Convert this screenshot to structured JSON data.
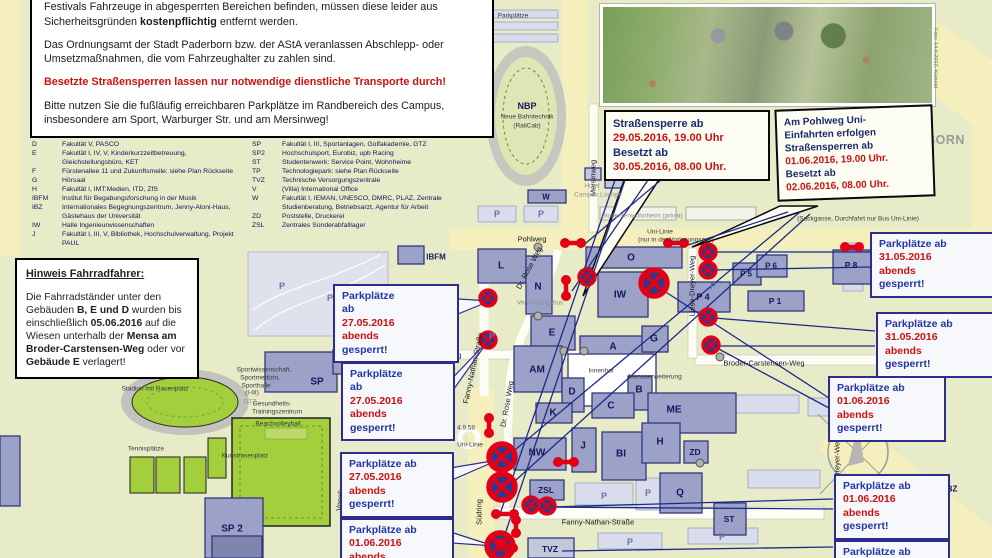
{
  "colors": {
    "accent_red": "#cc1111",
    "navy": "#2b2e8f",
    "sign_red": "#e30016",
    "sign_blue": "#2b3990",
    "map_green": "#e7ebc8",
    "street_yellow": "#f5efbe",
    "field_green": "#a3cf3c",
    "building": "#9ba1c7"
  },
  "info_box": {
    "p1": [
      {
        "t": "Verbotszeichen abgesperrt. Sollten sich während des Festivalaufbaues oder während des Festivals Fahrzeuge in abgesperrten Bereichen befinden, müssen diese leider aus Sicherheitsgründen "
      },
      {
        "t": "kostenpflichtig",
        "b": 1
      },
      {
        "t": " entfernt werden."
      }
    ],
    "p2": "Das Ordnungsamt der Stadt Paderborn bzw. der AStA veranlassen Abschlepp- oder Umsetzmaßnahmen, die vom Fahrzeughalter zu zahlen sind.",
    "p3": "Besetzte Straßensperren lassen nur notwendige dienstliche Transporte durch!",
    "p4": "Bitte nutzen Sie die fußläufig erreichbaren Parkplätze im Randbereich des Campus, insbesondere am Sport, Warburger Str. und am Mersinweg!"
  },
  "legend": {
    "col1": [
      {
        "code": "D",
        "text": "Fakultät V, PASCO"
      },
      {
        "code": "E",
        "text": "Fakultät I, IV, V, Kinderkurzzeitbetreuung, Gleichstellungsbüro, KET"
      },
      {
        "code": "F",
        "text": "Fürstenallee 11 und Zukunftsmeile: siehe Plan Rückseite"
      },
      {
        "code": "G",
        "text": "Hörsaal"
      },
      {
        "code": "H",
        "text": "Fakultät I, IMT:Medien, ITD, ZfS"
      },
      {
        "code": "IBFM",
        "text": "Institut für Begabungsforschung in der Musik"
      },
      {
        "code": "IBZ",
        "text": "Internationales Begegnungszentrum, Jenny-Aloni-Haus, Gästehaus der Universität"
      },
      {
        "code": "IW",
        "text": "Halle Ingenieurwissenschaften"
      },
      {
        "code": "J",
        "text": "Fakultät I, III, V, Bibliothek, Hochschulverwaltung, Projekt PAUL"
      }
    ],
    "col2": [
      {
        "code": "SP",
        "text": "Fakultät I, III, Sportanlagen, Golfakademie, GTZ"
      },
      {
        "code": "SP2",
        "text": "Hochschulsport, Eurobiz, upb Racing"
      },
      {
        "code": "ST",
        "text": "Studentenwerk: Service Point, Wohnheime"
      },
      {
        "code": "TP",
        "text": "Technologiepark: siehe Plan Rückseite"
      },
      {
        "code": "TVZ",
        "text": "Technische Versorgungszentrale"
      },
      {
        "code": "V",
        "text": "(Villa) International Office"
      },
      {
        "code": "W",
        "text": "Fakultät I, IEMAN, UNESCO, DMRC, PLAZ, Zentrale Studienberatung, Betriebsarzt, Agentur für Arbeit"
      },
      {
        "code": "ZD",
        "text": "Poststelle, Druckerei"
      },
      {
        "code": "ZSL",
        "text": "Zentrales Sonderabfalllager"
      }
    ]
  },
  "bike_note": {
    "title": "Hinweis Fahrradfahrer:",
    "body": [
      {
        "t": "Die Fahrradständer unter den Gebäuden "
      },
      {
        "t": "B, E und D",
        "b": 1
      },
      {
        "t": " wurden bis einschließlich "
      },
      {
        "t": "05.06.2016",
        "b": 1
      },
      {
        "t": " auf die Wiesen unterhalb der "
      },
      {
        "t": "Mensa am Broder-Carstensen-Weg",
        "b": 1
      },
      {
        "t": " oder vor "
      },
      {
        "t": "Gebäude E",
        "b": 1
      },
      {
        "t": " verlagert!"
      }
    ]
  },
  "roadblock_boxes": [
    {
      "x": 604,
      "y": 110,
      "w": 148,
      "fs": 11,
      "lines": [
        {
          "t": "Straßensperre  ab",
          "c": "t"
        },
        {
          "t": "29.05.2016, 19.00 Uhr",
          "c": "d"
        },
        {
          "t": "Besetzt ab",
          "c": "t"
        },
        {
          "t": "30.05.2016, 08.00 Uhr.",
          "c": "d"
        }
      ]
    },
    {
      "x": 776,
      "y": 107,
      "w": 140,
      "fs": 10,
      "rot": -2,
      "lines": [
        {
          "t": "Am Pohlweg Uni-",
          "c": "t"
        },
        {
          "t": "Einfahrten erfolgen",
          "c": "t"
        },
        {
          "t": "Straßensperren  ab",
          "c": "t"
        },
        {
          "t": "01.06.2016, 19.00 Uhr.",
          "c": "d"
        },
        {
          "t": "Besetzt ab",
          "c": "t"
        },
        {
          "t": "02.06.2016, 08.00 Uhr.",
          "c": "d"
        }
      ]
    }
  ],
  "parking_boxes": [
    {
      "x": 333,
      "y": 284,
      "w": 108,
      "lines": [
        {
          "t": "Parkplätze",
          "c": "t"
        },
        {
          "t": "ab",
          "c": "t"
        },
        {
          "t": "27.05.2016",
          "c": "d"
        },
        {
          "t": "abends",
          "c": "d"
        },
        {
          "t": "gesperrt!",
          "c": "t"
        }
      ]
    },
    {
      "x": 341,
      "y": 362,
      "w": 96,
      "lines": [
        {
          "t": "Parkplätze",
          "c": "t"
        },
        {
          "t": "ab",
          "c": "t"
        },
        {
          "t": "27.05.2016",
          "c": "d"
        },
        {
          "t": "abends",
          "c": "d"
        },
        {
          "t": "gesperrt!",
          "c": "t"
        }
      ]
    },
    {
      "x": 340,
      "y": 452,
      "w": 96,
      "lines": [
        {
          "t": "Parkplätze ab",
          "c": "t"
        },
        {
          "t": "27.05.2016",
          "c": "d"
        },
        {
          "t": "abends",
          "c": "d"
        },
        {
          "t": "gesperrt!",
          "c": "t"
        }
      ]
    },
    {
      "x": 340,
      "y": 518,
      "w": 96,
      "lines": [
        {
          "t": "Parkplätze ab",
          "c": "t"
        },
        {
          "t": "01.06.2016",
          "c": "d"
        },
        {
          "t": "abends",
          "c": "d"
        }
      ]
    },
    {
      "x": 870,
      "y": 232,
      "w": 106,
      "lines": [
        {
          "t": "Parkplätze ab",
          "c": "t"
        },
        {
          "t": "31.05.2016",
          "c": "d"
        },
        {
          "t": "abends",
          "c": "d"
        },
        {
          "t": "gesperrt!",
          "c": "t"
        }
      ]
    },
    {
      "x": 876,
      "y": 312,
      "w": 100,
      "lines": [
        {
          "t": "Parkplätze ab",
          "c": "t"
        },
        {
          "t": "31.05.2016",
          "c": "d"
        },
        {
          "t": "abends",
          "c": "d"
        },
        {
          "t": "gesperrt!",
          "c": "t"
        }
      ]
    },
    {
      "x": 828,
      "y": 376,
      "w": 100,
      "lines": [
        {
          "t": "Parkplätze ab",
          "c": "t"
        },
        {
          "t": "01.06.2016",
          "c": "d"
        },
        {
          "t": "abends",
          "c": "d"
        },
        {
          "t": "gesperrt!",
          "c": "t"
        }
      ]
    },
    {
      "x": 834,
      "y": 474,
      "w": 98,
      "lines": [
        {
          "t": "Parkplätze ab",
          "c": "t"
        },
        {
          "t": "01.06.2016",
          "c": "d"
        },
        {
          "t": "abends",
          "c": "d"
        },
        {
          "t": "gesperrt!",
          "c": "t"
        }
      ]
    },
    {
      "x": 834,
      "y": 540,
      "w": 98,
      "lines": [
        {
          "t": "Parkplätze ab",
          "c": "t"
        },
        {
          "t": "31.05.2016",
          "c": "d"
        }
      ]
    }
  ],
  "logo": {
    "line1": "UNIVERSITÄT PADERBORN",
    "line2": "Die Universität der Informationsgesellschaft"
  },
  "photo": {
    "caption": "Foto: 14.6.2013, Kiebold"
  },
  "compass": {
    "label": "N"
  },
  "map": {
    "labels": [
      {
        "t": "Pohlweg",
        "x": 532,
        "y": 239,
        "cls": "street"
      },
      {
        "t": "Südring",
        "x": 470,
        "y": 88,
        "cls": "street",
        "r": -90
      },
      {
        "t": "Südring",
        "x": 479,
        "y": 512,
        "cls": "street",
        "r": -90
      },
      {
        "t": "Mersinweg",
        "x": 593,
        "y": 178,
        "cls": "street",
        "r": -90
      },
      {
        "t": "Harsewinkelweg",
        "x": 434,
        "y": 355,
        "cls": "street"
      },
      {
        "t": "Dr. Rose Weg",
        "x": 529,
        "y": 268,
        "cls": "street",
        "r": -62
      },
      {
        "t": "Dr. Rose Weg",
        "x": 507,
        "y": 404,
        "cls": "street",
        "r": -80
      },
      {
        "t": "Fanny-Nathan-Straße",
        "x": 473,
        "y": 368,
        "cls": "street",
        "r": -78
      },
      {
        "t": "Fanny-Nathan-Straße",
        "x": 598,
        "y": 522,
        "cls": "street"
      },
      {
        "t": "Liese-Dreyer-Weg",
        "x": 692,
        "y": 286,
        "cls": "street",
        "r": -90
      },
      {
        "t": "Liese-Dreyer-Weg",
        "x": 837,
        "y": 468,
        "cls": "street",
        "r": -90
      },
      {
        "t": "Broder-Carstensen-Weg",
        "x": 764,
        "y": 363,
        "cls": "street"
      },
      {
        "t": "Vogeliusweg",
        "x": 341,
        "y": 490,
        "cls": "street",
        "r": -83
      },
      {
        "t": "Uni-Linie",
        "x": 470,
        "y": 445,
        "cls": "sk"
      },
      {
        "t": "4.9.58",
        "x": 466,
        "y": 428,
        "cls": "sk"
      },
      {
        "t": "Uni-Linie",
        "x": 660,
        "y": 232,
        "cls": "sk"
      },
      {
        "t": "(nur in der Vorlesungszeit)",
        "x": 676,
        "y": 240,
        "cls": "sk"
      },
      {
        "t": "(Sackgasse, Durchfahrt nur Bus Uni-Linie)",
        "x": 858,
        "y": 219,
        "cls": "sk"
      },
      {
        "t": "Parkplätze",
        "x": 513,
        "y": 16,
        "cls": "sk"
      },
      {
        "t": "AStA",
        "x": 446,
        "y": 52,
        "cls": "sg"
      },
      {
        "t": "Hotel",
        "x": 592,
        "y": 186,
        "cls": "sg"
      },
      {
        "t": "Campus Lounge",
        "x": 598,
        "y": 195,
        "cls": "sg"
      },
      {
        "t": "Studentenwohnheim (privat)",
        "x": 642,
        "y": 216,
        "cls": "sg"
      },
      {
        "t": "Verbindungsbus",
        "x": 540,
        "y": 303,
        "cls": "sg"
      },
      {
        "t": "Studentenwohnheime",
        "x": 886,
        "y": 402,
        "cls": "sg"
      },
      {
        "t": "Peter-Hille-Weg 1 und 13",
        "x": 888,
        "y": 411,
        "cls": "sg"
      },
      {
        "t": "Sportwissenschaft,",
        "x": 264,
        "y": 370,
        "cls": "sk"
      },
      {
        "t": "Sportmedizin,",
        "x": 260,
        "y": 378,
        "cls": "sk"
      },
      {
        "t": "Sporthalle",
        "x": 256,
        "y": 386,
        "cls": "sk"
      },
      {
        "t": "(I-III)",
        "x": 252,
        "y": 393,
        "cls": "sk"
      },
      {
        "t": "GTZ",
        "x": 250,
        "y": 402,
        "cls": "sg"
      },
      {
        "t": "Gesundheits-",
        "x": 272,
        "y": 404,
        "cls": "sk"
      },
      {
        "t": "Trainingszentrum",
        "x": 277,
        "y": 412,
        "cls": "sk"
      },
      {
        "t": "Beachvolleyball",
        "x": 278,
        "y": 424,
        "cls": "sk"
      },
      {
        "t": "Tennisplätze",
        "x": 146,
        "y": 449,
        "cls": "sk"
      },
      {
        "t": "Kunstrasenplatz",
        "x": 245,
        "y": 456,
        "cls": "sk"
      },
      {
        "t": "Stadion mit Rasenplatz",
        "x": 155,
        "y": 389,
        "cls": "sk"
      },
      {
        "t": "Innenhof",
        "x": 601,
        "y": 371,
        "cls": "sk"
      },
      {
        "t": "Mensaerweiterung",
        "x": 655,
        "y": 377,
        "cls": "sk"
      },
      {
        "t": "NBP",
        "x": 527,
        "y": 106,
        "cls": "bld",
        "s": 9
      },
      {
        "t": "Neue Bahntechnik",
        "x": 527,
        "y": 117,
        "cls": "sk"
      },
      {
        "t": "(RailCab)",
        "x": 527,
        "y": 126,
        "cls": "sk"
      },
      {
        "t": "L",
        "x": 501,
        "y": 266,
        "cls": "bld"
      },
      {
        "t": "N",
        "x": 538,
        "y": 287,
        "cls": "bld"
      },
      {
        "t": "O",
        "x": 631,
        "y": 258,
        "cls": "bld"
      },
      {
        "t": "IW",
        "x": 620,
        "y": 295,
        "cls": "bld"
      },
      {
        "t": "W",
        "x": 546,
        "y": 197,
        "cls": "bld",
        "s": 8
      },
      {
        "t": "E",
        "x": 552,
        "y": 333,
        "cls": "bld"
      },
      {
        "t": "AM",
        "x": 537,
        "y": 370,
        "cls": "bld"
      },
      {
        "t": "A",
        "x": 613,
        "y": 347,
        "cls": "bld"
      },
      {
        "t": "G",
        "x": 654,
        "y": 339,
        "cls": "bld"
      },
      {
        "t": "D",
        "x": 572,
        "y": 392,
        "cls": "bld"
      },
      {
        "t": "B",
        "x": 639,
        "y": 390,
        "cls": "bld"
      },
      {
        "t": "C",
        "x": 611,
        "y": 406,
        "cls": "bld"
      },
      {
        "t": "ME",
        "x": 674,
        "y": 410,
        "cls": "bld"
      },
      {
        "t": "K",
        "x": 553,
        "y": 413,
        "cls": "bld"
      },
      {
        "t": "J",
        "x": 583,
        "y": 446,
        "cls": "bld"
      },
      {
        "t": "BI",
        "x": 621,
        "y": 454,
        "cls": "bld"
      },
      {
        "t": "H",
        "x": 660,
        "y": 442,
        "cls": "bld"
      },
      {
        "t": "NW",
        "x": 537,
        "y": 453,
        "cls": "bld"
      },
      {
        "t": "ZD",
        "x": 695,
        "y": 452,
        "cls": "bld",
        "s": 8.5
      },
      {
        "t": "Q",
        "x": 680,
        "y": 493,
        "cls": "bld"
      },
      {
        "t": "ZSL",
        "x": 546,
        "y": 490,
        "cls": "bld",
        "s": 8.5
      },
      {
        "t": "TVZ",
        "x": 550,
        "y": 549,
        "cls": "bld",
        "s": 8.5
      },
      {
        "t": "ST",
        "x": 729,
        "y": 519,
        "cls": "bld",
        "s": 8.5
      },
      {
        "t": "SP",
        "x": 317,
        "y": 382,
        "cls": "bld"
      },
      {
        "t": "SP 2",
        "x": 232,
        "y": 529,
        "cls": "bld"
      },
      {
        "t": "P 4",
        "x": 703,
        "y": 297,
        "cls": "bld",
        "s": 9
      },
      {
        "t": "P 5",
        "x": 746,
        "y": 274,
        "cls": "bld",
        "s": 8
      },
      {
        "t": "P 6",
        "x": 771,
        "y": 266,
        "cls": "bld",
        "s": 8
      },
      {
        "t": "P 1",
        "x": 775,
        "y": 301,
        "cls": "bld",
        "s": 8.5
      },
      {
        "t": "P 8",
        "x": 851,
        "y": 265,
        "cls": "bld",
        "s": 8.5
      },
      {
        "t": "IBFM",
        "x": 436,
        "y": 257,
        "cls": "bld",
        "s": 8
      },
      {
        "t": "IBZ",
        "x": 951,
        "y": 489,
        "cls": "bld",
        "s": 8
      }
    ],
    "p_letters": [
      [
        497,
        214
      ],
      [
        541,
        214
      ],
      [
        604,
        496
      ],
      [
        648,
        493
      ],
      [
        630,
        542
      ],
      [
        722,
        537
      ],
      [
        492,
        336
      ],
      [
        713,
        286
      ],
      [
        282,
        286
      ],
      [
        330,
        298
      ]
    ],
    "symbols": {
      "no_stopping_icon_small": [
        [
          587,
          277
        ],
        [
          708,
          252
        ],
        [
          708,
          270
        ],
        [
          708,
          317
        ],
        [
          711,
          345
        ],
        [
          488,
          298
        ],
        [
          488,
          340
        ],
        [
          531,
          505
        ],
        [
          547,
          506
        ]
      ],
      "no_stopping_icon_large": [
        [
          654,
          283
        ],
        [
          502,
          457
        ],
        [
          502,
          487
        ],
        [
          500,
          546
        ]
      ],
      "roadblock_icon": [
        [
          565,
          243,
          581,
          243
        ],
        [
          566,
          280,
          566,
          296
        ],
        [
          668,
          243,
          684,
          243
        ],
        [
          845,
          247,
          859,
          247
        ],
        [
          963,
          240,
          977,
          240
        ],
        [
          489,
          418,
          489,
          433
        ],
        [
          558,
          462,
          574,
          462
        ],
        [
          496,
          514,
          514,
          514
        ],
        [
          516,
          520,
          516,
          533
        ],
        [
          500,
          543,
          513,
          548
        ]
      ]
    }
  }
}
